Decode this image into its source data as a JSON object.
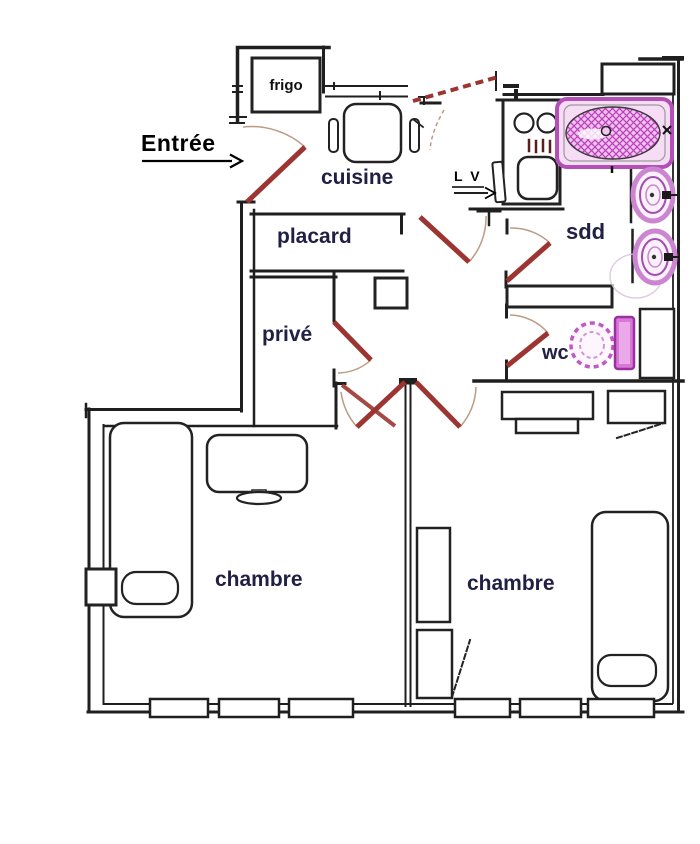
{
  "title": "apartment-floor-plan",
  "colors": {
    "wall": "#1f1f1f",
    "door": "#9c3531",
    "door_arc": "#b59078",
    "fixture": "#b44fb8",
    "fixture_fill": "#f6dcf4",
    "label": "#202044",
    "arrow": "#000000"
  },
  "labels": {
    "entree": "Entrée",
    "frigo": "frigo",
    "cuisine": "cuisine",
    "lave_vaisselle": "L V",
    "placard": "placard",
    "prive": "privé",
    "sdd": "sdd",
    "wc": "wc",
    "chambre_left": "chambre",
    "chambre_right": "chambre"
  },
  "fixtures": [
    "bathtub-icon",
    "washbasin-icon",
    "washbasin-icon",
    "toilet-icon",
    "stove-icon",
    "kitchen-sink-icon",
    "dishwasher-icon",
    "fridge-icon",
    "kitchen-table-icon",
    "chair-icon",
    "bed-icon",
    "bed-icon",
    "pedestal-table-icon",
    "desk-icon",
    "wardrobe-icon",
    "radiator-shelf-icon",
    "window-icon"
  ]
}
